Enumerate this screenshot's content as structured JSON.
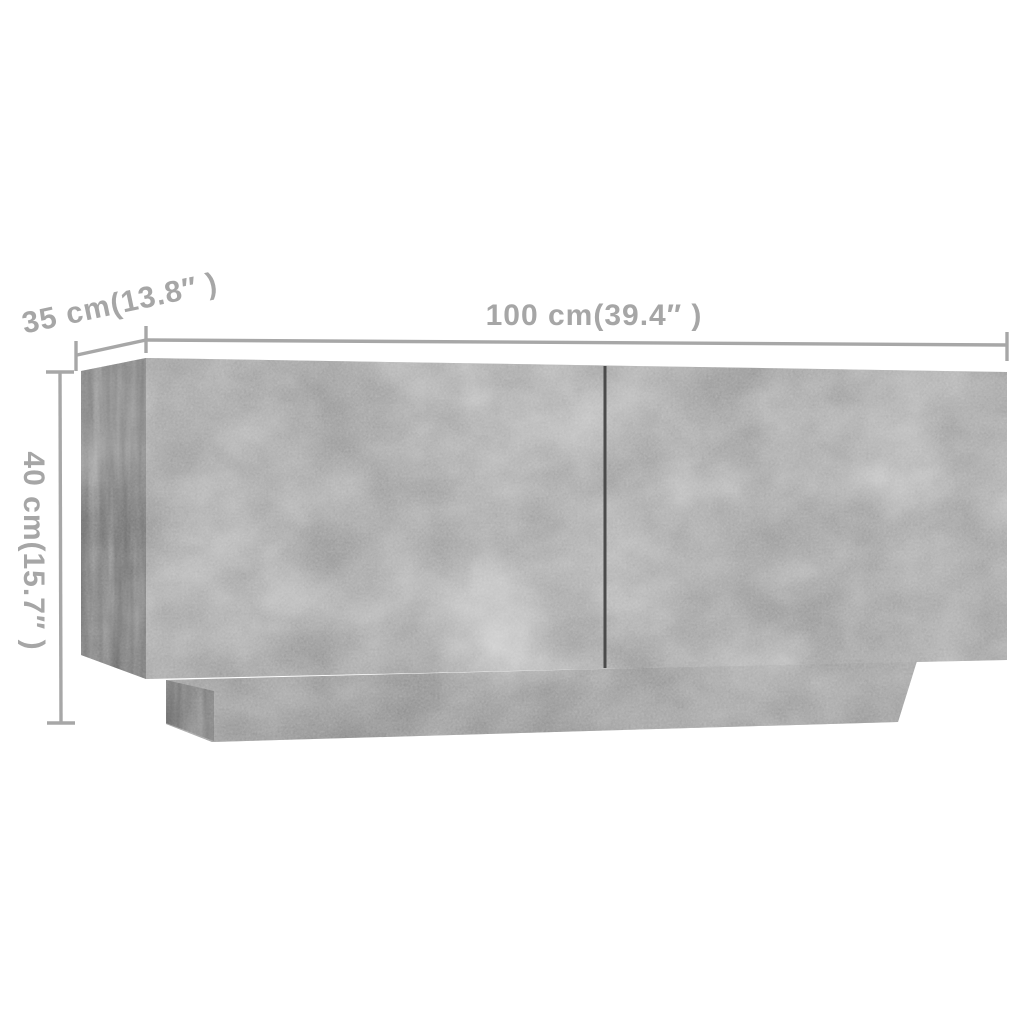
{
  "image_type": "product-dimension-diagram",
  "product_render": "tv-cabinet-concrete-gray",
  "labels": {
    "width": "100 cm(39.4″ )",
    "depth": "35 cm(13.8″ )",
    "height": "40 cm(15.7″ )"
  },
  "dimensions": {
    "width": {
      "value_cm": 100,
      "value_inch": 39.4
    },
    "depth": {
      "value_cm": 35,
      "value_inch": 13.8
    },
    "height": {
      "value_cm": 40,
      "value_inch": 15.7
    }
  },
  "colors": {
    "background": "#ffffff",
    "dimension_annotation": "#a7a7a7",
    "label_text": "#a6a6a6",
    "cabinet_front": "#b3b3b3",
    "cabinet_side": "#a3a3a3",
    "plinth_front": "#ababab",
    "plinth_side": "#9a9a9a",
    "door_gap": "#4a4a4a"
  }
}
